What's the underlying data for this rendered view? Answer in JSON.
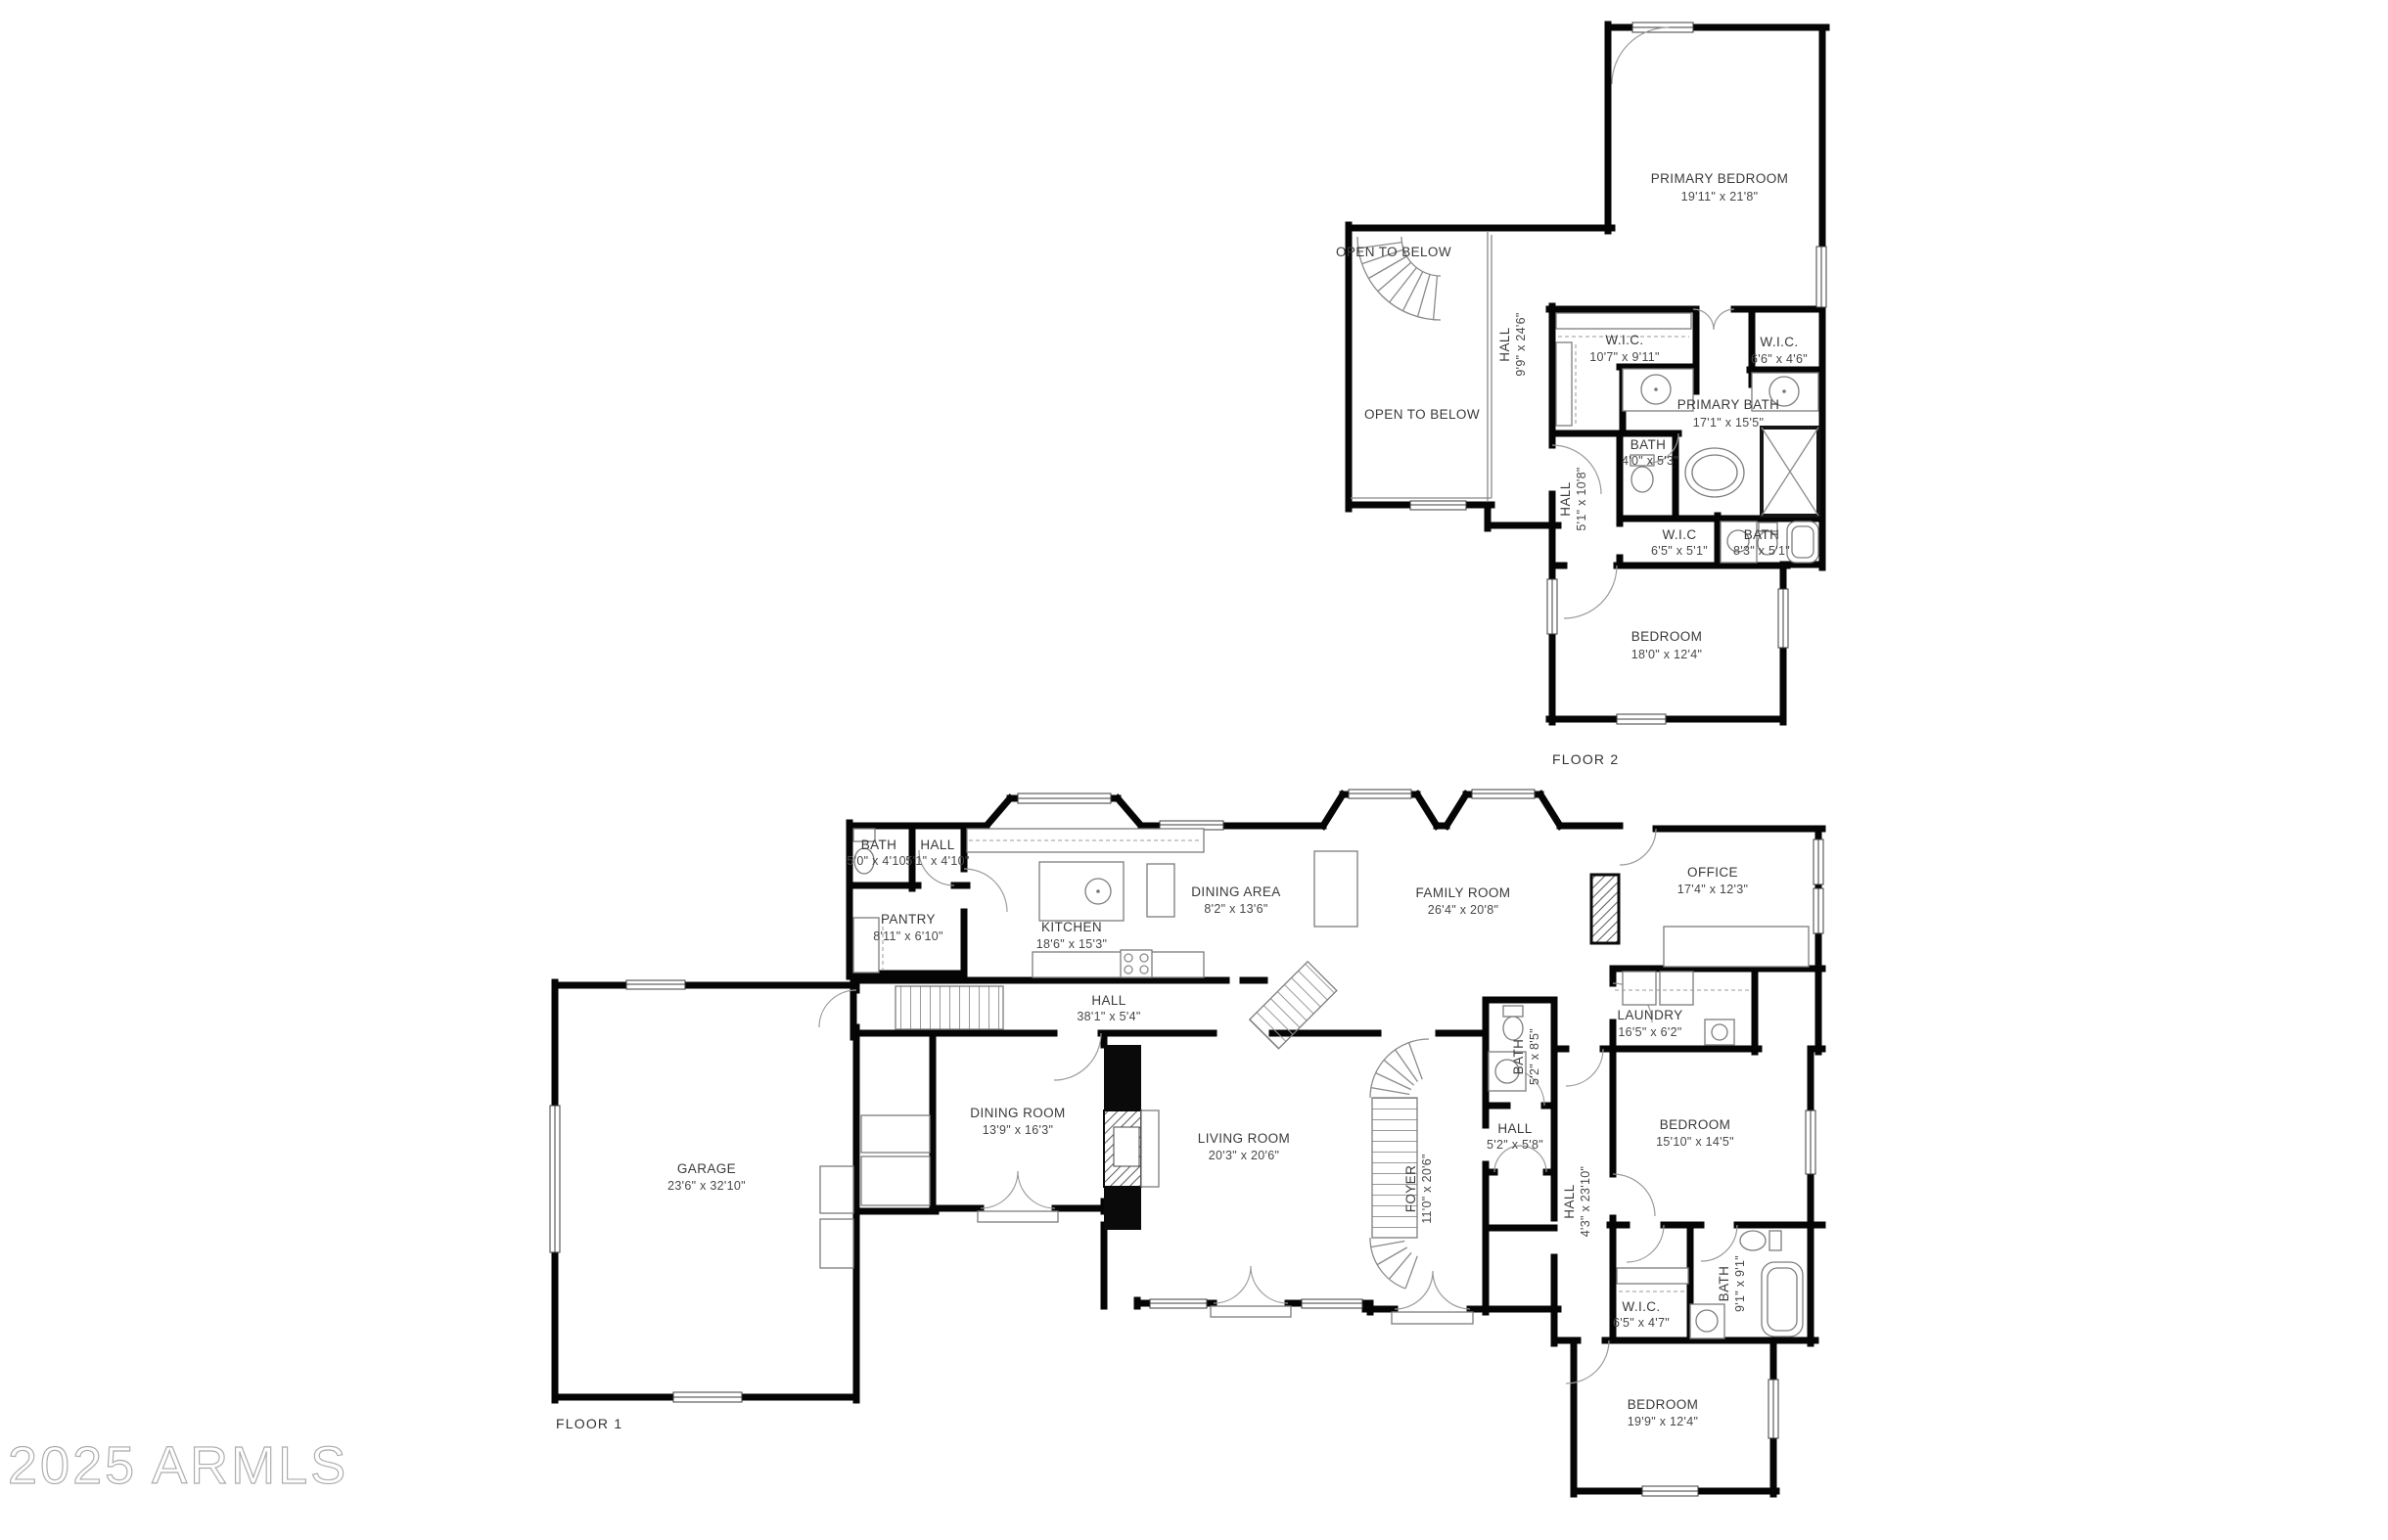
{
  "watermark": {
    "text": "2025 ARMLS"
  },
  "colors": {
    "wall": "#050505",
    "label": "#3a3a3a",
    "watermark": "#ababab",
    "background": "#ffffff"
  },
  "floor2": {
    "label": "FLOOR 2",
    "rooms": [
      {
        "name": "PRIMARY BEDROOM",
        "dims": "19'11\" x 21'8\""
      },
      {
        "name": "OPEN TO BELOW",
        "dims": ""
      },
      {
        "name": "HALL",
        "dims": "9'9\" x 24'6\""
      },
      {
        "name": "OPEN TO BELOW",
        "dims": ""
      },
      {
        "name": "W.I.C.",
        "dims": "10'7\" x 9'11\""
      },
      {
        "name": "W.I.C.",
        "dims": "6'6\" x 4'6\""
      },
      {
        "name": "PRIMARY BATH",
        "dims": "17'1\" x 15'5\""
      },
      {
        "name": "BATH",
        "dims": "4'0\" x 5'3\""
      },
      {
        "name": "HALL",
        "dims": "5'1\" x 10'8\""
      },
      {
        "name": "W.I.C",
        "dims": "6'5\" x 5'1\""
      },
      {
        "name": "BATH",
        "dims": "8'3\" x 5'1\""
      },
      {
        "name": "BEDROOM",
        "dims": "18'0\" x 12'4\""
      }
    ]
  },
  "floor1": {
    "label": "FLOOR 1",
    "rooms": [
      {
        "name": "BATH",
        "dims": "5'0\" x 4'10\""
      },
      {
        "name": "HALL",
        "dims": "5'1\" x 4'10\""
      },
      {
        "name": "PANTRY",
        "dims": "8'11\" x 6'10\""
      },
      {
        "name": "KITCHEN",
        "dims": "18'6\" x 15'3\""
      },
      {
        "name": "DINING AREA",
        "dims": "8'2\" x 13'6\""
      },
      {
        "name": "FAMILY ROOM",
        "dims": "26'4\" x 20'8\""
      },
      {
        "name": "OFFICE",
        "dims": "17'4\" x 12'3\""
      },
      {
        "name": "LAUNDRY",
        "dims": "16'5\" x 6'2\""
      },
      {
        "name": "HALL",
        "dims": "38'1\" x 5'4\""
      },
      {
        "name": "GARAGE",
        "dims": "23'6\" x 32'10\""
      },
      {
        "name": "DINING ROOM",
        "dims": "13'9\" x 16'3\""
      },
      {
        "name": "LIVING ROOM",
        "dims": "20'3\" x 20'6\""
      },
      {
        "name": "FOYER",
        "dims": "11'0\" x 20'6\""
      },
      {
        "name": "BATH",
        "dims": "5'2\" x 8'5\""
      },
      {
        "name": "HALL",
        "dims": "5'2\" x 5'8\""
      },
      {
        "name": "HALL",
        "dims": "4'3\" x 23'10\""
      },
      {
        "name": "BEDROOM",
        "dims": "15'10\" x 14'5\""
      },
      {
        "name": "BATH",
        "dims": "9'1\" x 9'1\""
      },
      {
        "name": "W.I.C.",
        "dims": "6'5\" x 4'7\""
      },
      {
        "name": "BEDROOM",
        "dims": "19'9\" x 12'4\""
      }
    ]
  }
}
